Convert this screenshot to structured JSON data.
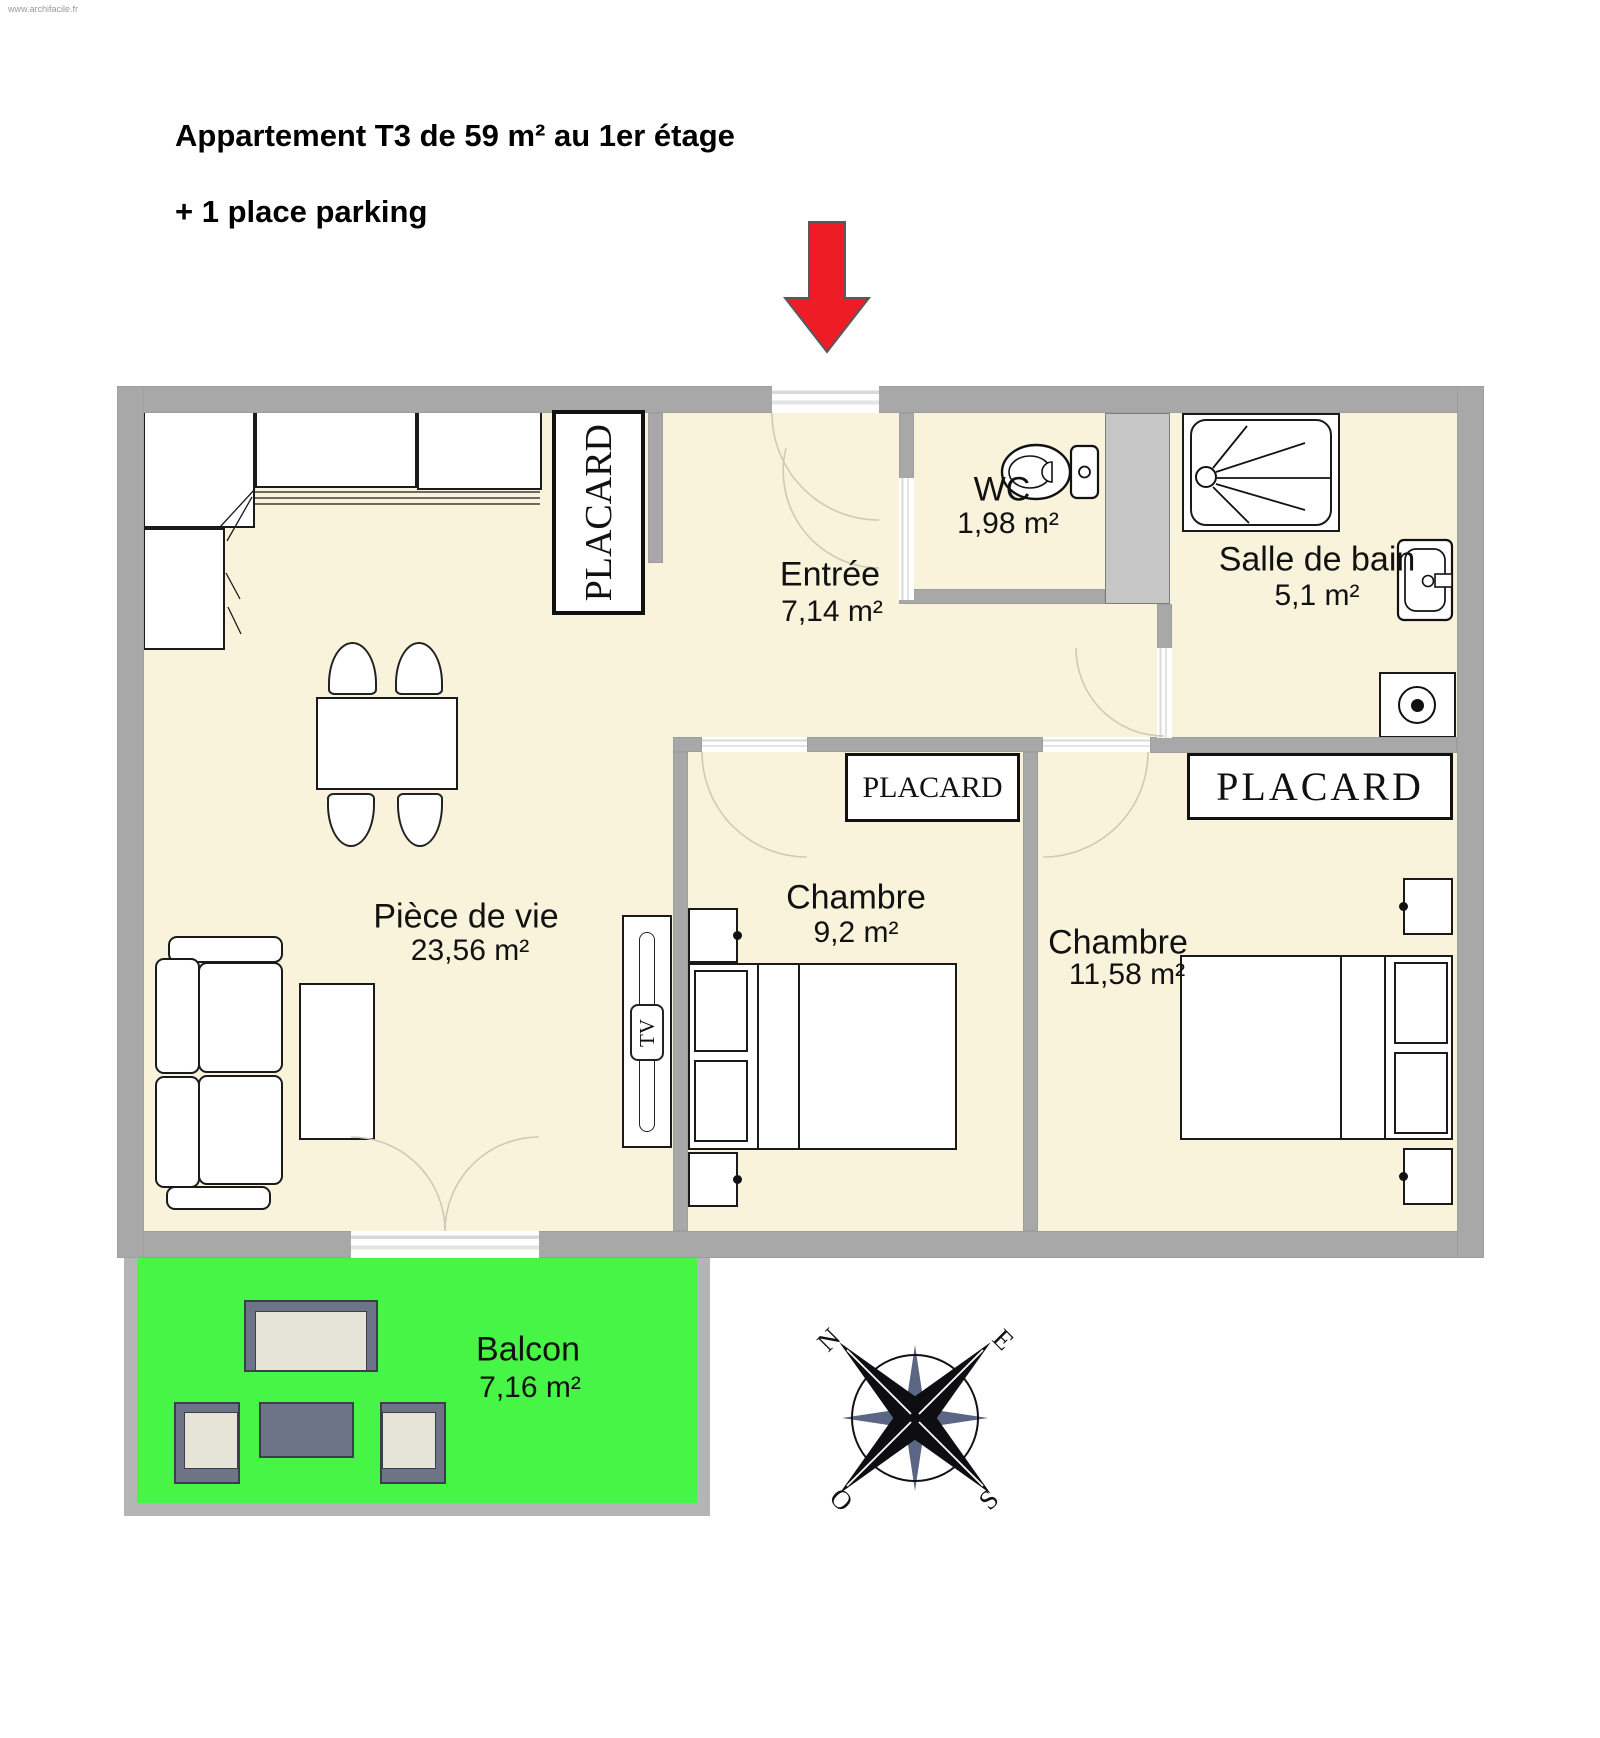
{
  "watermark": "www.archifacile.fr",
  "header": {
    "title": "Appartement T3 de 59 m² au 1er étage",
    "subtitle": "+ 1 place parking"
  },
  "rooms": {
    "entree": {
      "label": "Entrée",
      "area": "7,14 m²"
    },
    "wc": {
      "label": "WC",
      "area": "1,98 m²"
    },
    "salle_de_bain": {
      "label": "Salle de bain",
      "area": "5,1 m²"
    },
    "piece_de_vie": {
      "label": "Pièce de vie",
      "area": "23,56 m²"
    },
    "chambre1": {
      "label": "Chambre",
      "area": "9,2 m²"
    },
    "chambre2": {
      "label": "Chambre",
      "area": "11,58 m²"
    },
    "balcon": {
      "label": "Balcon",
      "area": "7,16 m²"
    }
  },
  "closets": {
    "hall": "PLACARD",
    "chambre1": "PLACARD",
    "chambre2": "PLACARD"
  },
  "furniture": {
    "tv": "TV"
  },
  "compass": {
    "north": "N",
    "east": "E",
    "south": "S",
    "west": "O"
  },
  "colors": {
    "floor": "#faf3dc",
    "wall": "#a8a8a8",
    "balcony_wall": "#b5b5b5",
    "balcony_green": "#46f546",
    "arrow_red": "#ee1c25",
    "shaft_gray": "#c6c6c6",
    "outdoor_furniture_slate": "#6e7487",
    "outdoor_cushion_beige": "#e6e3d7",
    "door_arc": "#cfc9ba"
  }
}
